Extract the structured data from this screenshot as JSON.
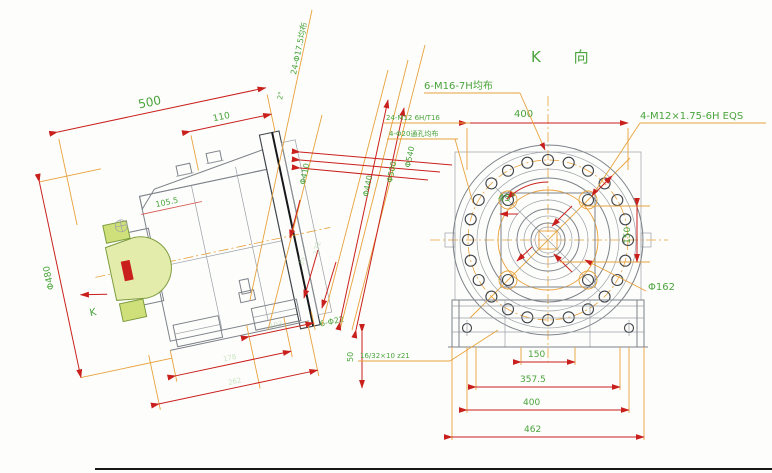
{
  "colors": {
    "dimension_red": "#c9201d",
    "label_green": "#4aa43c",
    "extension_orange": "#e8a23c",
    "drawing_gray": "#7d8289",
    "highlight_yellow": "#e4ecab",
    "highlight_mark_red": "#c9201d"
  },
  "view_title": {
    "k_view": "K 向"
  },
  "left_view": {
    "dim_overall_length": "500",
    "dim_flange_offset": "110",
    "dim_bell": "105.5",
    "note_holes_24": "24-Φ17.5均布",
    "note_taper": "2°",
    "dia_outer": "Φ540",
    "dia_mid": "Φ500",
    "dia_inner": "Φ440",
    "dia_pilot": "Φ410",
    "dia_yoke": "Φ480",
    "dim_172": "172",
    "dim_35": "35",
    "k_direction_label": "K",
    "note_holes_6": "6-Φ22",
    "dim_50": "50",
    "dim_foot_1": "103",
    "dim_foot_2": "178",
    "dim_foot_3": "262"
  },
  "right_view": {
    "note_m16": "6-M16-7H均布",
    "note_m12": "4-M12×1.75-6H EQS",
    "note_tap_line1": "24-M12 6H/T16",
    "note_tap_line2": "4-Φ20通孔均布",
    "angle": "45°",
    "dim_top": "400",
    "dim_right": "150",
    "dia_bore": "Φ162",
    "note_spline": "16/32×10 z21",
    "dim_bottom_1": "150",
    "dim_bottom_2": "357.5",
    "dim_bottom_3": "400",
    "dim_bottom_4": "462"
  }
}
